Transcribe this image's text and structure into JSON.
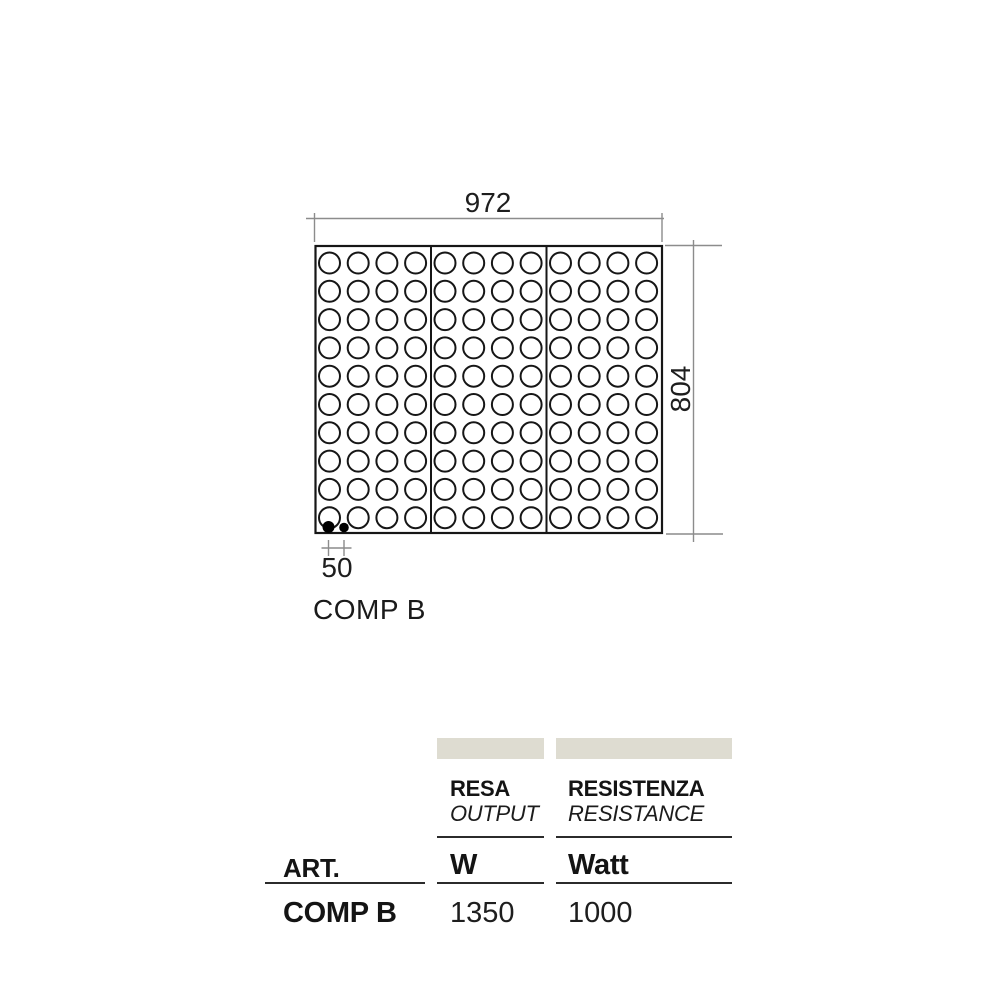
{
  "diagram": {
    "width_dim": "972",
    "height_dim": "804",
    "pitch_dim": "50",
    "label": "COMP B",
    "panel": {
      "sections": 3,
      "columns_per_section": 4,
      "rows": 10
    }
  },
  "table": {
    "swatch_color": "#dedcd1",
    "art_header": "ART.",
    "columns": [
      {
        "title": "RESA",
        "subtitle": "OUTPUT",
        "unit": "W"
      },
      {
        "title": "RESISTENZA",
        "subtitle": "RESISTANCE",
        "unit": "Watt"
      }
    ],
    "row": {
      "art": "COMP B",
      "resa": "1350",
      "resistenza": "1000"
    }
  }
}
